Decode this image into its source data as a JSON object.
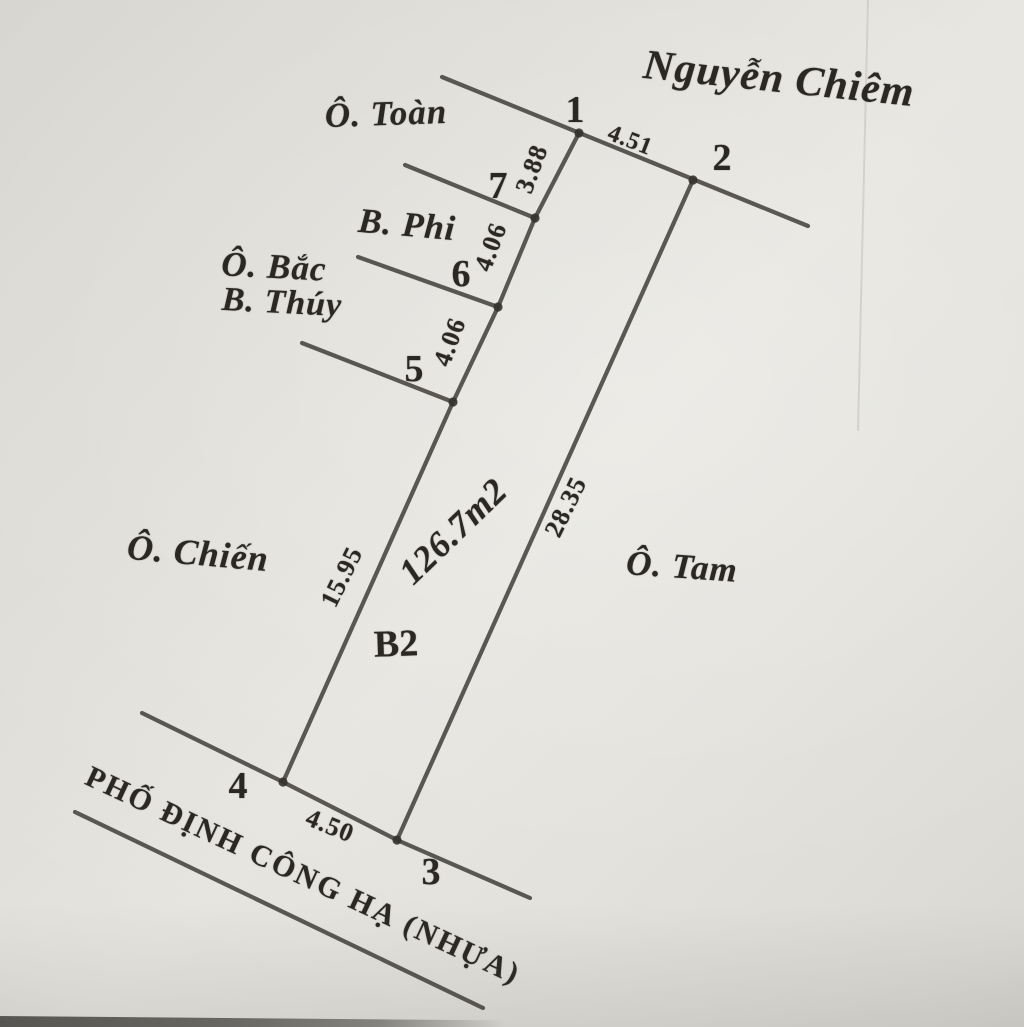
{
  "diagram": {
    "parcel": {
      "code": "B2",
      "area": "126.7m2"
    },
    "street": {
      "name": "PHỐ ĐỊNH CÔNG HẠ (NHỰA)"
    },
    "neighbors": {
      "chiem": "Nguyễn Chiêm",
      "toan": "Ô. Toàn",
      "phi": "B. Phi",
      "bac": "Ô. Bắc",
      "thuy": "B. Thúy",
      "chien": "Ô. Chiến",
      "tam": "Ô. Tam"
    },
    "points": {
      "p1": "1",
      "p2": "2",
      "p3": "3",
      "p4": "4",
      "p5": "5",
      "p6": "6",
      "p7": "7"
    },
    "dimensions": {
      "p1_p2": "4.51",
      "p1_p7": "3.88",
      "p7_p6": "4.06",
      "p6_p5": "4.06",
      "p5_p4": "15.95",
      "p2_p3": "28.35",
      "p4_p3": "4.50"
    },
    "colors": {
      "paper": "#e6e4de",
      "ink": "#2b2823",
      "line": "#46433d"
    }
  }
}
